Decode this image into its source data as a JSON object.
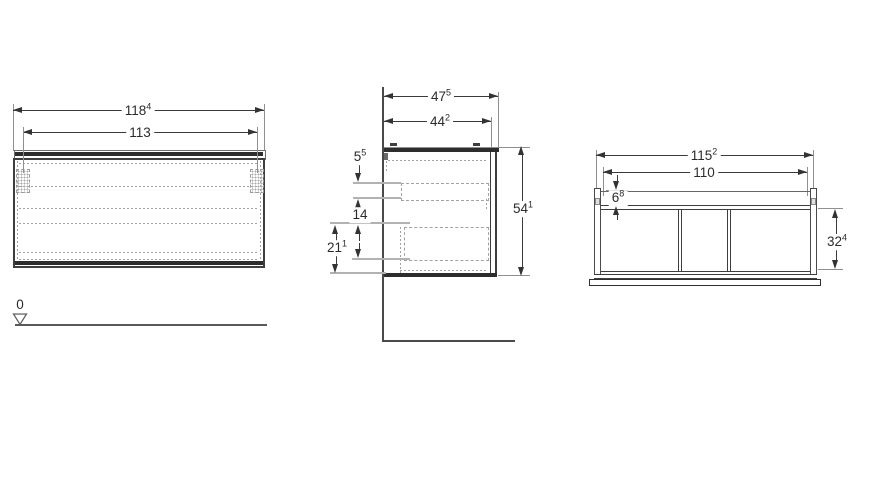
{
  "drawing_title": "vanity-cabinet-technical-drawing",
  "colors": {
    "outline": "#3e3e3e",
    "thick_edge": "#2d2d2d",
    "extension_line": "#8f8f8f",
    "hidden_line": "#a2a2a2",
    "text": "#2b2b2b"
  },
  "front_view": {
    "dim_overall_width": {
      "value": "118",
      "sup": "4"
    },
    "dim_fixing_width": {
      "value": "113",
      "sup": ""
    },
    "datum_label": "0"
  },
  "side_view": {
    "dim_depth_overall": {
      "value": "47",
      "sup": "5"
    },
    "dim_depth_body": {
      "value": "44",
      "sup": "2"
    },
    "dim_top_drawer_gap": {
      "value": "5",
      "sup": "5"
    },
    "dim_inner_drawer_height": {
      "value": "14",
      "sup": ""
    },
    "dim_lower_drawer_height": {
      "value": "21",
      "sup": "1"
    },
    "dim_height": {
      "value": "54",
      "sup": "1"
    }
  },
  "plan_view": {
    "dim_width_overall": {
      "value": "115",
      "sup": "2"
    },
    "dim_width_inner": {
      "value": "110",
      "sup": ""
    },
    "dim_side_offset": {
      "value": "6",
      "sup": "8"
    },
    "dim_depth": {
      "value": "32",
      "sup": "4"
    }
  }
}
